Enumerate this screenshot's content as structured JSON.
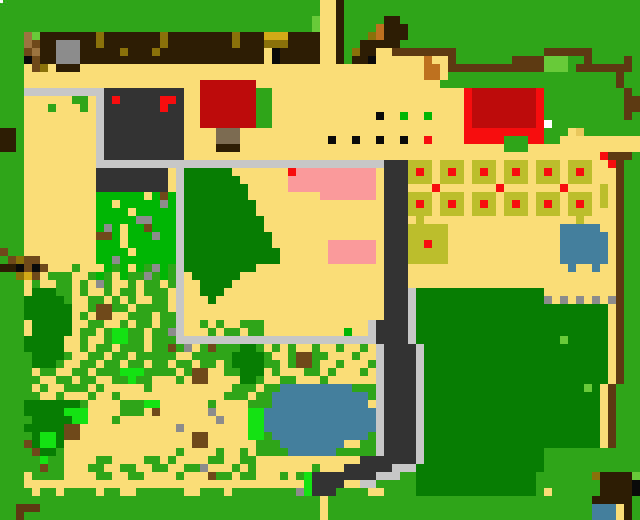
{
  "map": {
    "title": "farm-map",
    "width_px": 640,
    "height_px": 520,
    "tile_size": 8,
    "cols": 80,
    "rows": 65,
    "palette": {
      "G": {
        "color": "#2FA519",
        "name": "grass"
      },
      "g": {
        "color": "#00B605",
        "name": "bright-grass"
      },
      "v": {
        "color": "#15E212",
        "name": "vivid-weeds"
      },
      "D": {
        "color": "#077D03",
        "name": "dark-foliage"
      },
      "L": {
        "color": "#68C939",
        "name": "light-sprout"
      },
      "Y": {
        "color": "#FBDD77",
        "name": "sand-path"
      },
      "t": {
        "color": "#E9C75D",
        "name": "sand-shaded"
      },
      "W": {
        "color": "#C7C7C7",
        "name": "stone-path"
      },
      "w": {
        "color": "#8C8C8C",
        "name": "rock"
      },
      "K": {
        "color": "#333333",
        "name": "dark-building"
      },
      "k": {
        "color": "#0A0A0A",
        "name": "black-detail"
      },
      "B": {
        "color": "#2C1D04",
        "name": "dark-soil"
      },
      "b": {
        "color": "#5D3A12",
        "name": "wood-fence"
      },
      "n": {
        "color": "#70491B",
        "name": "stump"
      },
      "h": {
        "color": "#9B7440",
        "name": "light-log"
      },
      "R": {
        "color": "#F70D0D",
        "name": "bright-red"
      },
      "r": {
        "color": "#BD0B0B",
        "name": "dark-red-roof"
      },
      "P": {
        "color": "#FB9A9A",
        "name": "pink-blossom"
      },
      "U": {
        "color": "#44809D",
        "name": "water"
      },
      "O": {
        "color": "#BE7220",
        "name": "rust-gate"
      },
      "A": {
        "color": "#D2A917",
        "name": "gold-hay"
      },
      "d": {
        "color": "#8A7109",
        "name": "dark-olive"
      },
      "o": {
        "color": "#BDBE2C",
        "name": "crop-plot"
      },
      "e": {
        "color": "#FFFFFF",
        "name": "white-detail"
      },
      "T": {
        "color": "#7C6B51",
        "name": "trunk"
      }
    },
    "grid": [
      "GGGGGGGGGGGGGGGGGGGGGGGGGGGGGGGGGGGGGGGGYYBGGGGGGGGGGGGGGGGGGGGGGGGGGGGGGGGGGGG",
      "GGGGGGGGGGGGGGGGGGGGGGGGGGGGGGGGGGGGGGGGYYBGGGGGGGGGGGGGGGGGGGGGGGGGGGGGGGGGGGG",
      "GGGGGGGGGGGGGGGGGGGGGGGGGGGGGGGGGGGGGGGLYYBGGGGGBBGGGGGGGGGGGGGGGGGGGGGGGGGGGGG",
      "GGGGGGGGGGGGGGGGGGGGGGGGGGGGGGGGGGGGGGGLYYBGGGGOBBBGGGGGGGGGGGGGGGGGGGGGGGGGGGG",
      "GGGhLBBBBBBBdBBBBBBBdBBBBBBBBdBBBAAABBBBYYBGGGdOBBBGGGGGGGGGGGGGGGGGGGGGGGGGGGG",
      "GGGhnBBwwwBBdBBBBBBBdBBBBBBBBdBBBdddBBBBYYBGGBBBBBGGGGGGGGGGGGGGGGGGGGGGGGGGGGG",
      "GGGnhBBwwwBBBBBdBBBdBBBBBBBBBBBBBYkBBBBBYYBGdBBYYbbbbbbbbGGGGGGGGGGGbbbbbbGGGGGG",
      "GGGknBBwwwBBBBBBBBBBBBBBBBBBBBBBBYkBBBBBYYBGBBkYYYYYYOYYbGGGGGGGbbbbLLLGGbGGGGbG",
      "GGGYndYBBBYYYYYYYYYYYYYYYYYYYYYYYYYYYYYYYYYYYYYYYYYYYOOYbbbbbbbbbbbbLLLGbbbbbbbG",
      "GGGYYYYYYYYYYYYYYYYYYYYYYYYYYYYYYYYYYYYYYYYYYYYYYYYYYOOYGGGGGGGGGGGGGGGGGGGGGbG",
      "GGGYYYYYYYYYYYYYYYYYYYYYYrrrrrrrYYYYYYYYYYYYYYYYYYYYYYYGGGGGGGGGGGGGGGGGGGGGGbG",
      "GGGWWWWWWWWWWKKKKKKKKKKYYrrrrrrrGGYYYYYYYYYYYYYYYYYYYYYYYYRrrrrrrrrRGGGGGGGGGGbG",
      "GGGYYYYYYGGYWKRKKKKKRRKYYrrrrrrrGGYYYYYYYYYYYYYYYYYYYYYYYYRrrrrrrrrRGGGGGGGGGGbb",
      "GGGYYYGYYYGYWKKKKKKKRKKYYrrrrrrrGGYYYYYYYYYYYYYYYYYYYYYYYYRrrrrrrrrRGGGGGGGGGGbb",
      "GGGYYYYYYYYYWKKKKKKKKKKYYrrrrrrrGGYYYYYYYYYYYYYkYYgYYgYYYYRrrrrrrrrRGGGGGGGGGGbG",
      "GGGYYYYYYYYYWKKKKKKKKKKYYrrrrrrrGGYYYYYYYYYYYYYYYYYYYYYYYYRrrrrrrrrReGGGGGGGGGGG",
      "BBGYYYYYYYYYWKKKKKKKKKKYYYYTTTYYYYYYYYYYYYYYYYYYYYYYYYYYYYRRRRRRRRRRGGGYtGGGGGGG",
      "BBGYYYYYYYYYWKKKKKKKKKKYYYYTTTYYYYYYYYYYYkYYkYYkYYkYYRYYYYRRRRRGGGRRGGYYYYYYYYYY",
      "BBGYYYYYYYYYWKKKKKKKKKKYYYYBBBYYYYYYYYYYYYYYYYYYYYYYYYYYYYYYYYYGGGYYYYYYYYYYYYYY",
      "GGGYYYYYYYYYWKKKKKKKKKKYYYYYYYYYYYYYYYYYYYYYYYYYYYYYYYYYYYYYYYYYYYYYYYYYYYYRbbb",
      "GGGYYYYYYYYYWWWWWWWWWWWWWWWWWWWWWWWWWWWWWWWWWWWWKKKoooYoooYoooYoooYoooYoooYYRbGG",
      "GGGYYYYYYYYYKKKKKKKKKYWDDDDDDYYYYYYYRPPPPPPPPPPYKKKoRoYoRoYoRoYoRoYoRoYoRoYYYbGG",
      "GGGYYYYYYYYYKKKKKKKKKYWDDDDDDDYYYYYYPPPPPPPPPPPYKKKoooYoooYoooYoooYoooYoooYYYbGG",
      "GGGYYYYYYYYYKKKKKKKKKYWDDDDDDDDYYYYYPPPPPPPPPPPYKKKYYYRYYYYYYYRYYYYYYYRYYYYoYbGG",
      "GGGYYYYYYYYYggggggYgngWDDDDDDDDYYYYYYYYYPPPPPPPYKKKoooYoooYoooYoooYoooYoooYoYbGG",
      "GGGYYYYYYYYYggYgggggwgWDDDDDDDDDYYYYYYYYYYYYYYYYKKKoRoYoRoYoRoYoRoYoRoYoRoYoYbGG",
      "GGGYYYYYYYYYggggYgggggWDDDDDDDDDYYYYYYYYYYYYYYYYKKKoooYoooYoooYoooYoooYoooYYYbGG",
      "GGGYYYYYYYYYgggggwwgggWDDDDDDDDDDYYYYYYYYYYYYYYYKKKYoYYYYYYYYYYYYYYYYYYYoYYYYbGG",
      "GGGYYYYYYYYYgwgYggngggWDDDDDDDDDDYYYYYYYYYYYYYYYKKKoooooYYYYYYYYYYYYYYUUUUUYYbGG",
      "GGGYYYYYYYYYnngYgggwggWDDDDDDDDDDDYYYYYYYYYYYYYYKKKoooooYYYYYYYYYYYYYYUUUUUUYbGG",
      "GGGYYYYYYYYYgggYggggggWDDDDDDDDDDDYYYYYYYPPPPPPYKKKooRooYYYYYYYYYYYYYYUUUUUUYbGG",
      "nGGYYYYYYYYYggggYgggggWDDDDDDDDDDDDYYYYYYPPPPPPYKKKoooooYYYYYYYYYYYYYYUUUUUUYbGG",
      "GndnnYYYYYYYggwgggggggWDDDDDDDDDDDDYYYYYYPPPPPPYKKKoooooYYYYYYYYYYYYYYUUUUUUYbGG",
      "BBknknYYYGYYYgGgYgGwgGWDDDDDDDDDYYYYYYYYYYYYYYYYKKKYYYYYYYYYYYYYYYYYYYYUYYUYYbGG",
      "GGdAnYGGGYYGgGYgGGwGgGWYDDDDDDYYYYYYYYYYYYYYYYYYKKKYYYYYYYYYYYYYYYYYYYYYYYYYYbGG",
      "GGGYGYYGGYGYwGYYGYGGYGWYYDDDDYYYYYYYYYYYYYYYYYYYKKKYYYYYYYYYYYYYYYYYYYYYYYYYYbGG",
      "GGGYDDDGGYGYYGYGGYGGGYWYYDDDYYYYYYYYYYYYYYYYYYYYKKKWDDDDDDDDDDDDDDDDYYYYYYYYYbGG",
      "GGGDDDDDGYYGGYGYGYYGGYWYYYDYYYYYYYYYYYYYYYYYYYYYKKKWDDDDDDDDDDDDDDDDwYwYwYwYwbGG",
      "GGGDDDDDDYYGnnGGYGGGGYWYYYYYYYYYYYYYYYYYYYYYYYYYKKKWDDDDDDDDDDDDDDDDDDDDDDDDYbGG",
      "GGGDDDDDDYGYnnYYGGGYGGWYYYYYYYYYYYYYYYYYYYYYYYYYKKKWDDDDDDDDDDDDDDDDDDDDDDDDYbGG",
      "GGGYDDDDDYYGGYYGYGGYGGWYYGYGYYGGGYYYYYYYYYYYYYWKKKKWDDDDDDDDDDDDDDDDDDDDDDDDYbGG",
      "GGGYDDDDDYGGYGvvGGYGGwWYYYGYGGYGGYYYYYYYYYYgYYWKKKKWDDDDDDDDDDDDDDDDDDDDDDDDYbGG",
      "GGGDDDDDYYGYYGvvGGYGGGWWWWWWWWWWWWWWWWWWWWWWWWWKKKKWDDDDDDDDDDDDDDDDDDLDDDDDYbGG",
      "GGGDDDDDYYGYGGYGGGYGGnGwYGnGGGDDGYGYGYYGYYGYYGYWKKKKWDDDDDDDDDDDDDDDDDDDDDDDYbGG",
      "GGGGDDDDGYYGGYGGYGGGGGYYGGGGGDDDDGYYGnnGGYYYGYYWKKKKWDDDDDDDDDDDDDDDDDDDDDDDYbGG",
      "GGGGDDDGYYGGYGGYGGYGGYGGYGGYGDDDDGGYGnnGYYGYYYGWKKKKWDDDDDDDDDDDDDDDDDDDDDDDYbGG",
      "GGGGYGGYYGGYGGGvvvGGGGYGnnYYGGDDDYGYYYGGYGYYYGYWKKKKWDDDDDDDDDDDDDDDDDDDDDDDYbGG",
      "GGGGGYYGGYGGYYGGvGGYYYGYnnYYYYDDGYYGGYYYGYYYYYYWKKKKWDDDDDDDDDDDDDDDDDDDDDDDYbGG",
      "GGGGYGYYGGGYGYYYYYGYYYYYYYYYYGGGYGGUUUUUUUUUGGGWKKKKWDDDDDDDDDDDDDDDDDDDDLDYbGG",
      "GGGGGYYGYYYGYYGYYYYYYYYYYYYYGGGYGGUUUUUUUUUUUUGWKKKKWDDDDDDDDDDDDDDDDDDDDDDYbGG",
      "GGGDDDDDDDGYYYYGGGvvYYYYYYGYYYYGGGUUUUUUUUUUUUYWKKKKWDDDDDDDDDDDDDDDDDDDDDDYbGG",
      "GGGDDDDDvvvYYYYGGGYnYYYYYYwYYYYvvUUUUUUUUUUUUUUWKKKKWDDDDDDDDDDDDDDDDDDDDDDYbGG",
      "GGGGDDDDDvvYYYGYYYYYYYYYYYYwYYYvvUUUUUUUUUUUUUUWKKKKWDDDDDDDDDDDDDDDDDDDDDDYbGG",
      "GGGDDDDDnnYYYYYYYYYYYYwYYYYYYYYvvUUUUUUUUUUUUUUWKKKKWDDDDDDDDDDDDDDDDDDDDDDYbGG",
      "GGGGDvvDnnYYYYYYYYYYYYYYnnYYYYYvvGUUUUUUUUUUUUGWKKKKWDDDDDDDDDDDDDDDDDDDDDDYbGG",
      "GGGnDvvDYYYYYYYYYYYYYYYYnnYYYYYYGGGUUUUUUUUYYGGWKKKKWDDDDDDDDDDDDDDDDDDDDDDYbGG",
      "GGGGnDDGYYYYYYYYYYYYYYGYYYYGYYGYGGGGUUUUUUGGGGGWKKKKWDDDDDDDDDDDDDDDGGGGGGGGGGGG",
      "GGGGGvGGYYYYGGYYYYGGYGYYYYGGYYGGYYYYYYYYYYYYYKKKKKKKWDDDDDDDDDDDDDDDGGGGGGGGGGGG",
      "GGGGGnGGYYYGGYYGGYYGGYYGGwYYYGYGYYYYYYYGYYYKKKKKKWWWDDDDDDDDDDDDDDDDGGGGGGGGGGGG",
      "GGGYGGGGYYYYGGYYGGYYYYGYYYnGGYGGYYYGYGvKKKKKKKKWWWGGDDDDDDDDDDDDDDDGGGGGGGdBBBBL",
      "GGGYYYYYYYYYYYYYYYYYYYYYYYYYYYYYYYYYYYvKKKKYYWWGGGGGDDDDDDDDDDDDDDDGGGGGGGGBBBBk",
      "GGGGYGGYGGGGYGGYYGGGGGGYYGGGYGGGGGGGGwvKKKGGGGYYGGGGDDDDDDDDDDDDDDDGYGGGGGGBBBBk",
      "GGGGGGGGGGGGGGGGGGGGGGGGGGGGGGGGGGGGGGGGYGGGGGGGGGGGGGGGGGGGGGGGGGGGGGGGGGBBBBB",
      "GGbbbGGGGGGGGGGGGGGGGGGGGGGGGGGGGGGGGGGGYGGGGGGGGGGGGGGGGGGGGGGGGGGGGGGGGGUUUYB",
      "GGbGGGGGGGGGGGGGGGGGGGGGGGGGGGGGGGGGGGGGYGGGGGGGGGGGGGGGGGGGGGGGGGGGGGGGGGUUUYB"
    ],
    "overlays": [
      {
        "x": 0,
        "y": 0,
        "w": 3,
        "h": 3,
        "color": "#FFFFFF",
        "name": "cursor-dot"
      }
    ]
  }
}
